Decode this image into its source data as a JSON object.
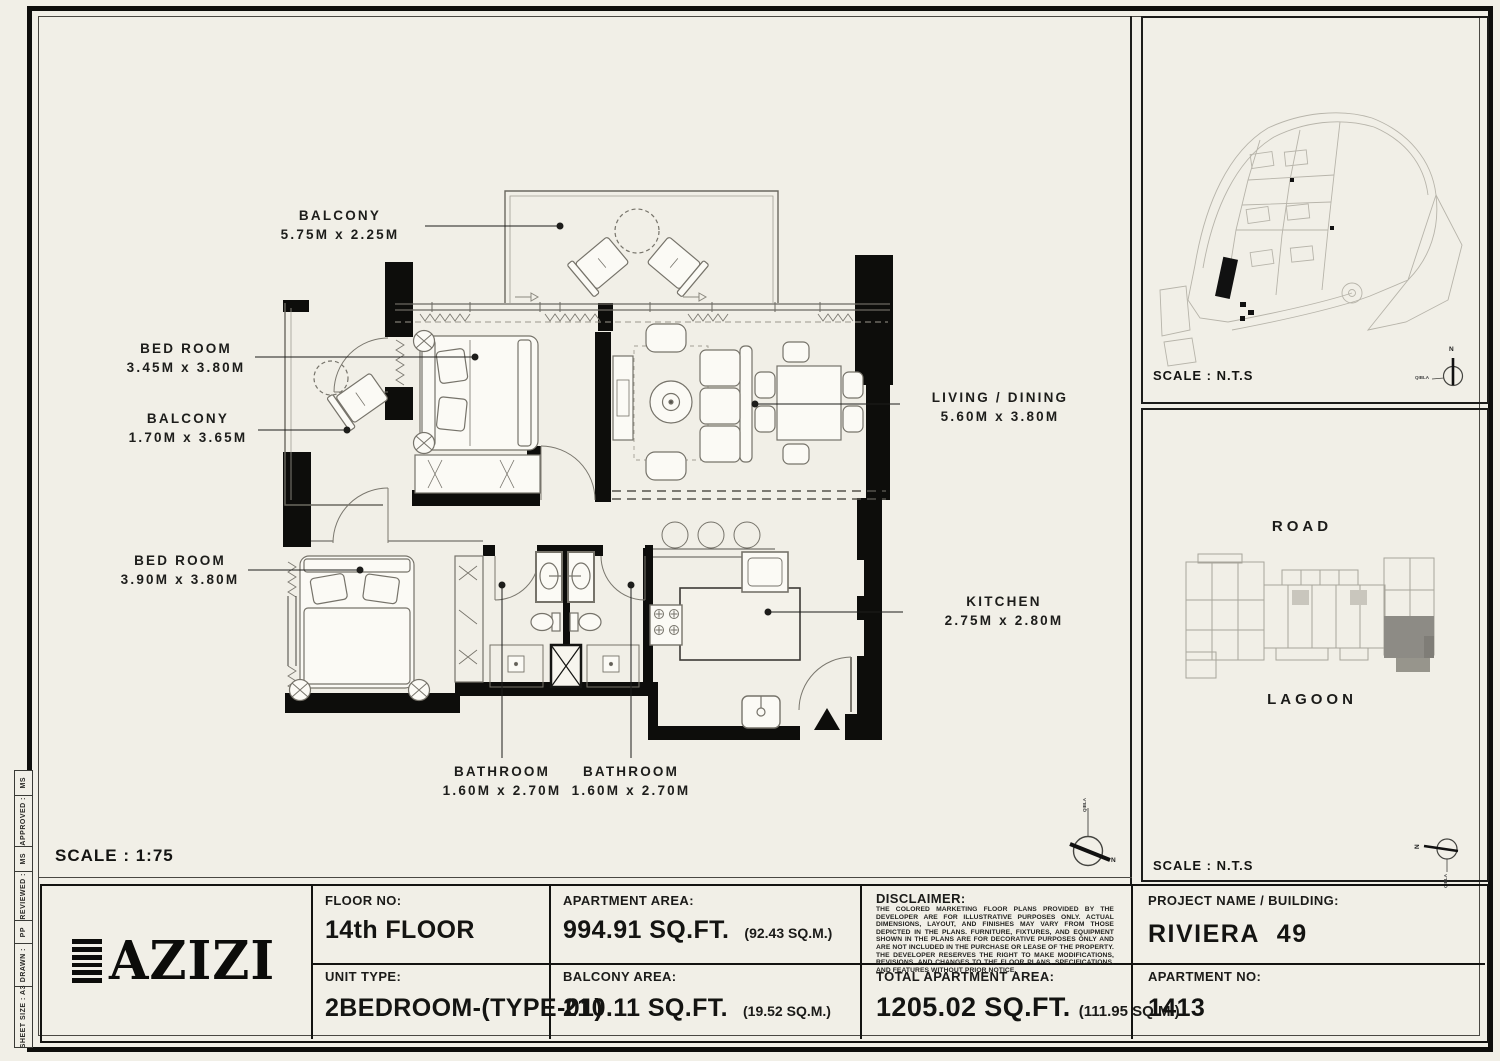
{
  "page": {
    "bg": "#f0eee5",
    "ink": "#141412",
    "scale_label": "SCALE : 1:75"
  },
  "plan": {
    "rooms": [
      {
        "name": "BALCONY",
        "dims": "5.75M x 2.25M"
      },
      {
        "name": "BED ROOM",
        "dims": "3.45M x 3.80M"
      },
      {
        "name": "BALCONY",
        "dims": "1.70M x 3.65M"
      },
      {
        "name": "BED ROOM",
        "dims": "3.90M x 3.80M"
      },
      {
        "name": "LIVING / DINING",
        "dims": "5.60M x 3.80M"
      },
      {
        "name": "KITCHEN",
        "dims": "2.75M x 2.80M"
      },
      {
        "name": "BATHROOM",
        "dims": "1.60M x 2.70M"
      },
      {
        "name": "BATHROOM",
        "dims": "1.60M x 2.70M"
      }
    ],
    "compass": {
      "north": "N",
      "qibla": "QIBLA"
    }
  },
  "sidebar": {
    "site_map": {
      "scale_label": "SCALE : N.T.S",
      "compass_north": "N",
      "compass_qibla": "QIBLA"
    },
    "location_map": {
      "road_label": "ROAD",
      "lagoon_label": "LAGOON",
      "scale_label": "SCALE : N.T.S",
      "compass_north": "N",
      "compass_qibla": "QIBLA"
    }
  },
  "title_block": {
    "logo_text": "AZIZI",
    "floor": {
      "label": "FLOOR NO:",
      "value": "14th FLOOR"
    },
    "unit_type": {
      "label": "UNIT TYPE:",
      "value": "2BEDROOM-(TYPE-01)"
    },
    "apartment_area": {
      "label": "APARTMENT AREA:",
      "value": "994.91 SQ.FT.",
      "metric": "(92.43 SQ.M.)"
    },
    "balcony_area": {
      "label": "BALCONY AREA:",
      "value": "210.11 SQ.FT.",
      "metric": "(19.52 SQ.M.)"
    },
    "disclaimer": {
      "label": "DISCLAIMER:",
      "text": "THE COLORED MARKETING FLOOR PLANS PROVIDED BY THE DEVELOPER ARE FOR ILLUSTRATIVE PURPOSES ONLY. ACTUAL DIMENSIONS, LAYOUT, AND FINISHES MAY VARY FROM THOSE DEPICTED IN THE PLANS. FURNITURE, FIXTURES, AND EQUIPMENT SHOWN IN THE PLANS ARE FOR DECORATIVE PURPOSES ONLY AND ARE NOT INCLUDED IN THE PURCHASE OR LEASE OF THE PROPERTY. THE DEVELOPER RESERVES THE RIGHT TO MAKE MODIFICATIONS, REVISIONS, AND CHANGES TO THE FLOOR PLANS, SPECIFICATIONS, AND FEATURES WITHOUT PRIOR NOTICE."
    },
    "total_area": {
      "label": "TOTAL APARTMENT AREA:",
      "value": "1205.02 SQ.FT.",
      "metric": "(111.95 SQ.M.)"
    },
    "project": {
      "label": "PROJECT NAME / BUILDING:",
      "value": "RIVIERA  49"
    },
    "apartment_no": {
      "label": "APARTMENT NO:",
      "value": "1413"
    }
  },
  "revision_strip": {
    "items": [
      "MS",
      "APPROVED :",
      "MS",
      "REVIEWED :",
      "PP",
      "DRAWN :",
      "SHEET SIZE : A3"
    ]
  }
}
